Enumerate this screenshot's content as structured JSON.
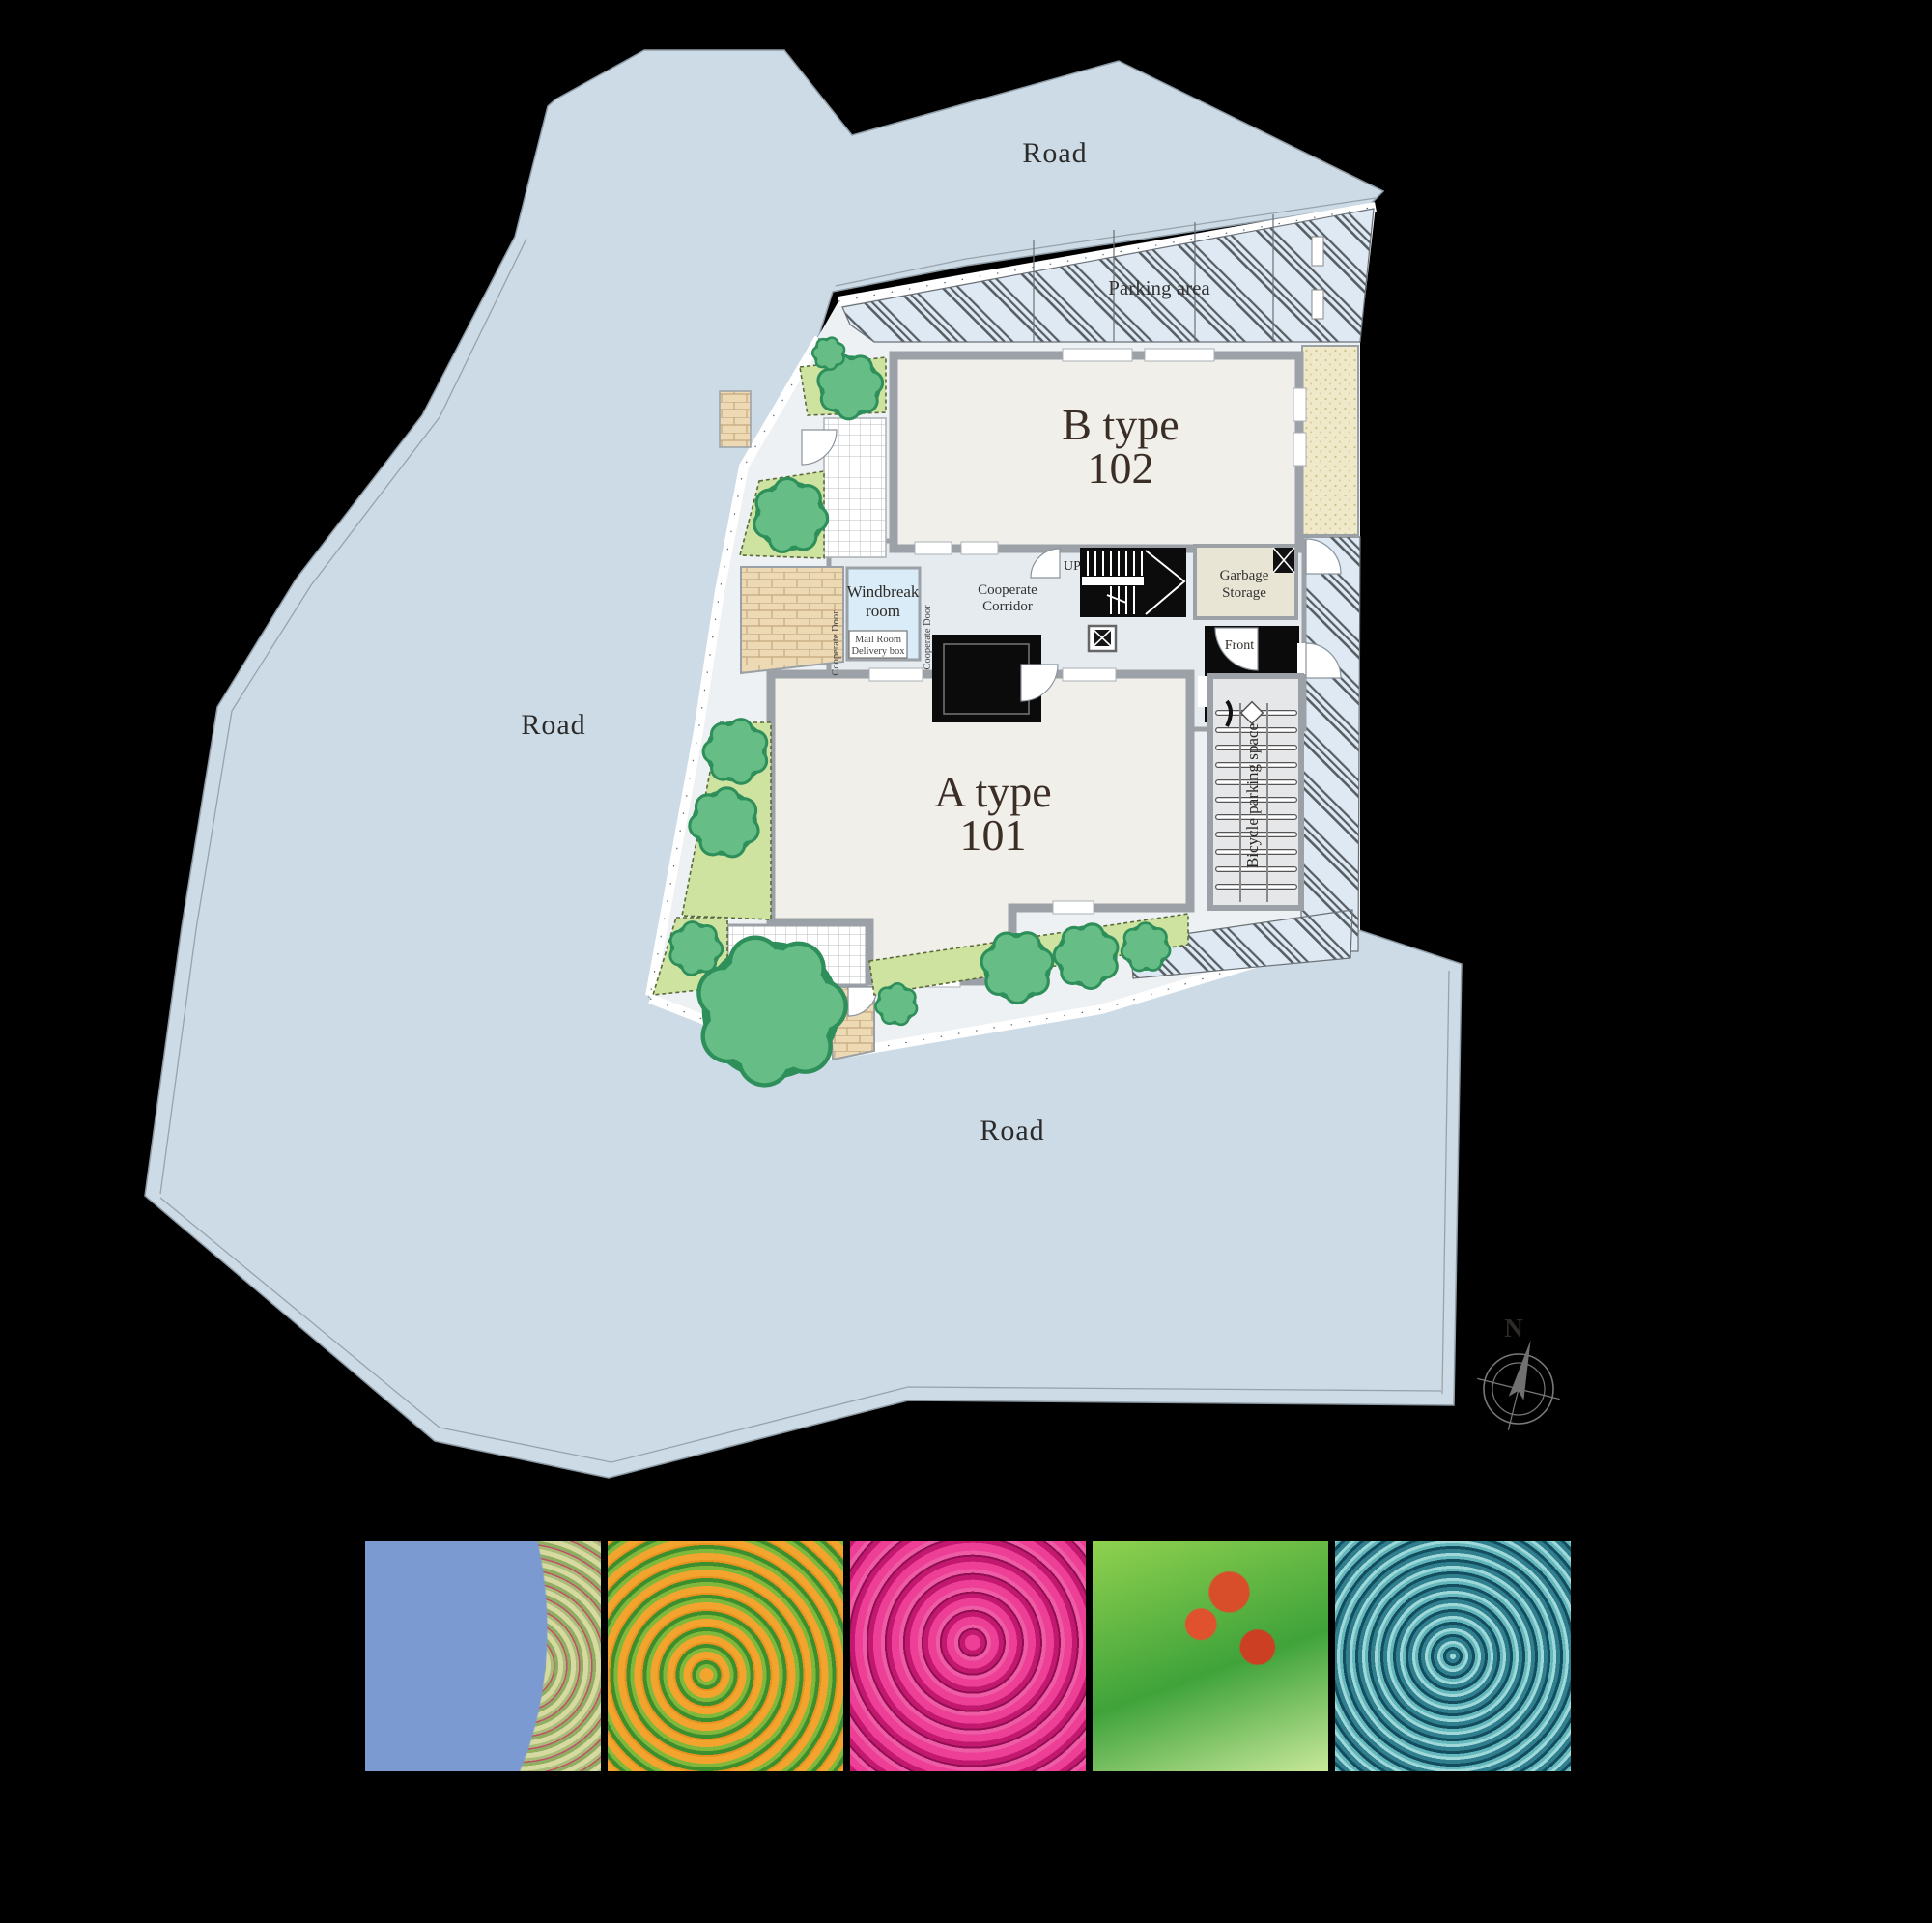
{
  "plan": {
    "roads": {
      "top": "Road",
      "left": "Road",
      "bottom": "Road"
    },
    "parking_label": "Parking area",
    "unit_b": {
      "line1": "B type",
      "line2": "102"
    },
    "unit_a": {
      "line1": "A type",
      "line2": "101"
    },
    "windbreak": {
      "line1": "Windbreak",
      "line2": "room"
    },
    "mailroom": {
      "line1": "Mail Room",
      "line2": "Delivery box"
    },
    "cooperate_door_left": "Cooperate Door",
    "cooperate_door_right": "Cooperate Door",
    "cooperate_corridor": {
      "line1": "Cooperate",
      "line2": "Corridor"
    },
    "up_label": "UP",
    "garbage": {
      "line1": "Garbage",
      "line2": "Storage"
    },
    "front_label": "Front",
    "bicycle_label": "Bicycle parking space",
    "compass_n": "N"
  },
  "colors": {
    "background": "#000000",
    "road": "#ccdbe5",
    "road_line": "#8f9ca6",
    "site_base": "#eef1f3",
    "parking_hatch_bg": "#dfe9f3",
    "hatch_line": "#565e64",
    "building": "#f1efe9",
    "wall": "#9ba1a6",
    "corridor": "#e6ebf0",
    "windbreak_room": "#d9ecf8",
    "brick": "#eed9b5",
    "garden": "#cfe3a0",
    "tree": "#66bd85",
    "tree_edge": "#2e8f5b",
    "gravel": "#efe9c9",
    "garbage_room": "#e9e5d4",
    "label_dark": "#3a2e26"
  },
  "photos": [
    {
      "id": "red-berry-tree-photo",
      "palette": [
        "#7b9ad2",
        "#c2506a",
        "#cdd49b"
      ]
    },
    {
      "id": "orange-osmanthus-photo",
      "palette": [
        "#f2a42e",
        "#58a033"
      ]
    },
    {
      "id": "pink-azalea-photo",
      "palette": [
        "#ee3f96",
        "#8f0f52"
      ]
    },
    {
      "id": "green-leaves-red-berries-photo",
      "palette": [
        "#3fa33a",
        "#d84d2a"
      ]
    },
    {
      "id": "blue-conifer-photo",
      "palette": [
        "#2f7f8f",
        "#9fd8d8"
      ]
    }
  ]
}
